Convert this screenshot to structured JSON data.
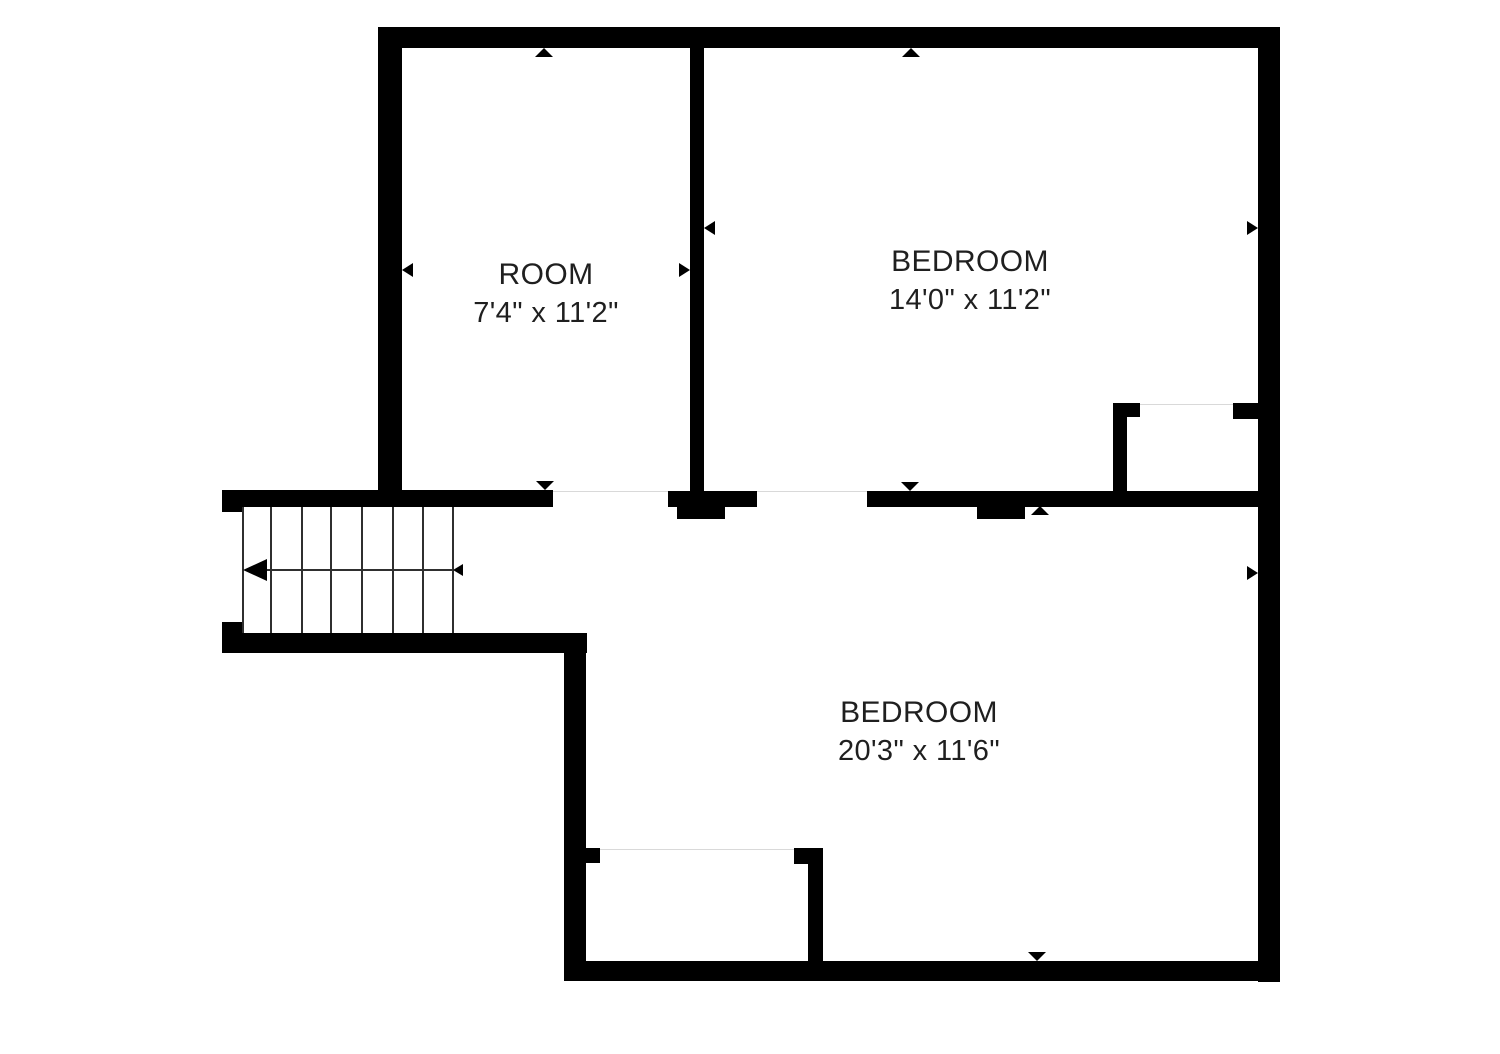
{
  "floor_plan": {
    "colors": {
      "wall": "#000000",
      "label_text": "#1f1f1f",
      "opening_line": "#d9d9d9",
      "stair_lines": "#2f2f2f",
      "background": "#ffffff"
    },
    "rooms": [
      {
        "name": "ROOM",
        "dimensions": "7'4\" x 11'2\""
      },
      {
        "name": "BEDROOM",
        "dimensions": "14'0\" x 11'2\""
      },
      {
        "name": "BEDROOM",
        "dimensions": "20'3\" x 11'6\""
      }
    ]
  }
}
